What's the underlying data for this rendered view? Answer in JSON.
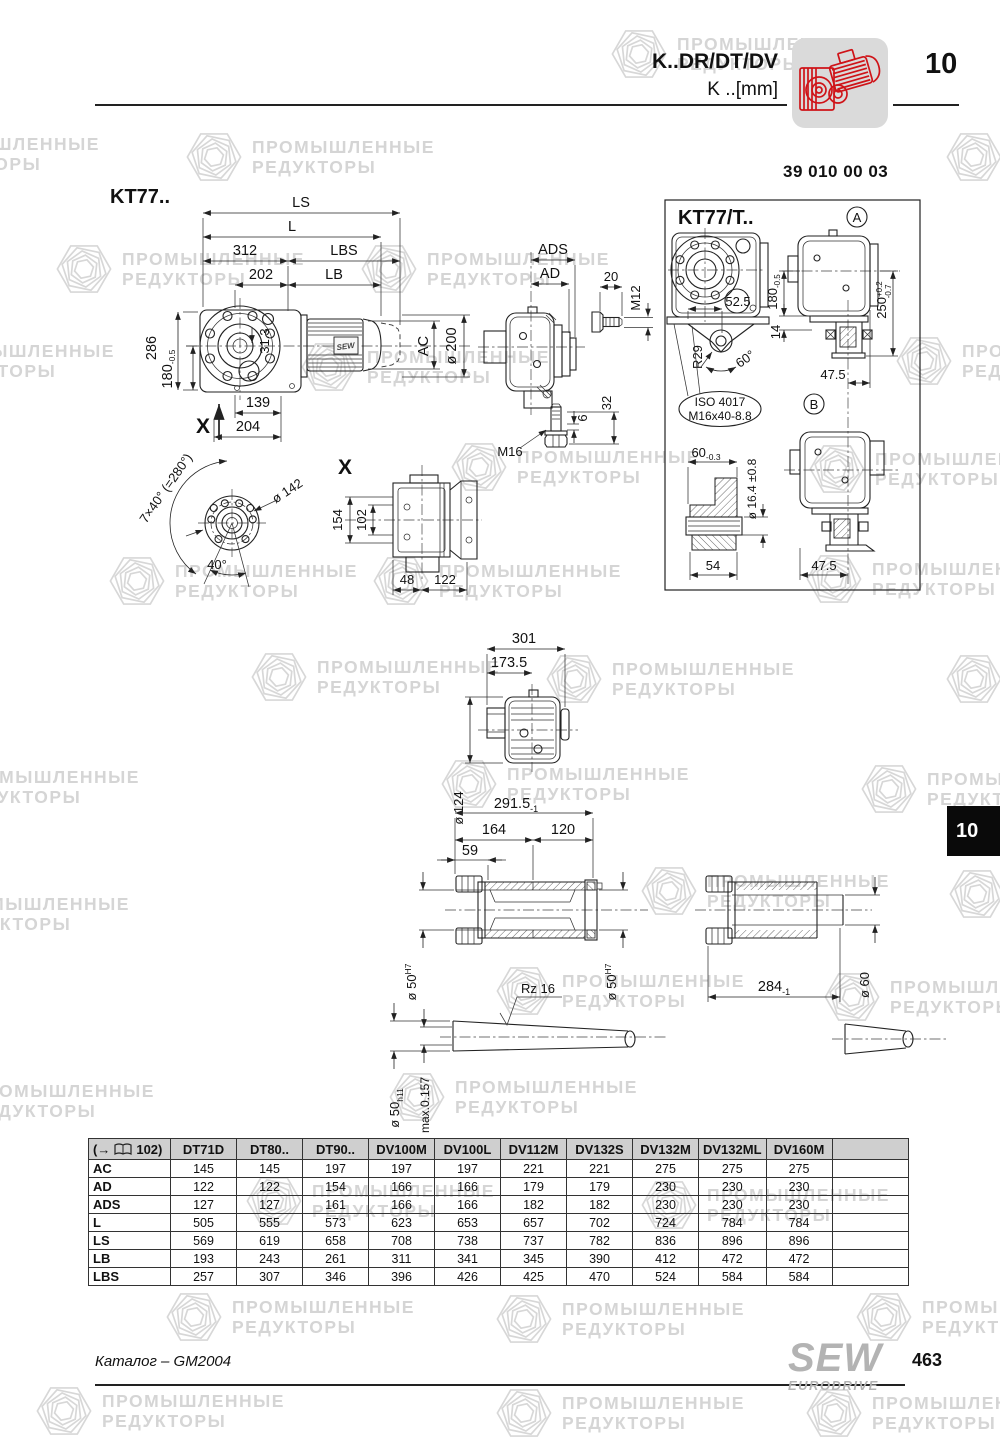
{
  "header": {
    "model": "K..DR/DT/DV",
    "unit": "K ..[mm]",
    "section": "10",
    "drawing_number": "39 010 00 03"
  },
  "watermark": {
    "line1": "ПРОМЫШЛЕННЫЕ",
    "line2": "РЕДУКТОРЫ"
  },
  "tab": {
    "label": "10"
  },
  "drawings": {
    "main": {
      "title": "KT77..",
      "ls": "LS",
      "l": "L",
      "d312": "312",
      "lbs": "LBS",
      "d202": "202",
      "lb": "LB",
      "d286": "286",
      "d180": "180",
      "t180": "-0.5",
      "d313": "31.3",
      "d139": "139",
      "d204": "204",
      "x": "X",
      "ac": "AC",
      "d200": "ø 200",
      "nameplate": "SEW"
    },
    "endview": {
      "ads": "ADS",
      "ad": "AD",
      "d20": "20",
      "m12": "M12",
      "d6": "6",
      "d32": "32",
      "m16": "M16"
    },
    "panel": {
      "title": "KT77/T..",
      "a": "A",
      "b": "B",
      "d525": "52.5",
      "r29": "R29",
      "a60": "60°",
      "iso1": "ISO 4017",
      "iso2": "M16x40-8.8",
      "d180": "180",
      "t180": "-0.5",
      "d14": "14",
      "d250": "250",
      "t250a": "+0.2",
      "t250b": "-0.7",
      "d475": "47.5",
      "d60": "60",
      "t60": "-0.3",
      "d164": "ø 16.4 ±0.8",
      "d54": "54"
    },
    "xview": {
      "x": "X",
      "pattern": "7×40° (=280°)",
      "d142": "ø 142",
      "a40": "40°",
      "d154": "154",
      "d102": "102",
      "d48": "48",
      "d122": "122"
    },
    "midview": {
      "d301": "301",
      "d1735": "173.5",
      "d124": "ø 124"
    },
    "hshaft": {
      "d2915": "291.5",
      "t2915": "-1",
      "d164": "164",
      "d120": "120",
      "d59": "59",
      "d50": "ø 50",
      "h7": "H7"
    },
    "sshaft": {
      "d60": "ø 60",
      "d284": "284",
      "t284": "-1"
    },
    "rod": {
      "rz": "Rz 16",
      "d50": "ø 50",
      "h11": "h11",
      "runout": "max.0.157"
    }
  },
  "table": {
    "ref_open": "(→",
    "ref_page": "102)",
    "columns": [
      "DT71D",
      "DT80..",
      "DT90..",
      "DV100M",
      "DV100L",
      "DV112M",
      "DV132S",
      "DV132M",
      "DV132ML",
      "DV160M"
    ],
    "rows": [
      {
        "label": "AC",
        "values": [
          "145",
          "145",
          "197",
          "197",
          "197",
          "221",
          "221",
          "275",
          "275",
          "275"
        ]
      },
      {
        "label": "AD",
        "values": [
          "122",
          "122",
          "154",
          "166",
          "166",
          "179",
          "179",
          "230",
          "230",
          "230"
        ]
      },
      {
        "label": "ADS",
        "values": [
          "127",
          "127",
          "161",
          "166",
          "166",
          "182",
          "182",
          "230",
          "230",
          "230"
        ]
      },
      {
        "label": "L",
        "values": [
          "505",
          "555",
          "573",
          "623",
          "653",
          "657",
          "702",
          "724",
          "784",
          "784"
        ]
      },
      {
        "label": "LS",
        "values": [
          "569",
          "619",
          "658",
          "708",
          "738",
          "737",
          "782",
          "836",
          "896",
          "896"
        ]
      },
      {
        "label": "LB",
        "values": [
          "193",
          "243",
          "261",
          "311",
          "341",
          "345",
          "390",
          "412",
          "472",
          "472"
        ]
      },
      {
        "label": "LBS",
        "values": [
          "257",
          "307",
          "346",
          "396",
          "426",
          "425",
          "470",
          "524",
          "584",
          "584"
        ]
      }
    ]
  },
  "footer": {
    "catalog": "Каталог – GM2004",
    "brand_top": "SEW",
    "brand_bottom": "EURODRIVE",
    "page": "463"
  }
}
